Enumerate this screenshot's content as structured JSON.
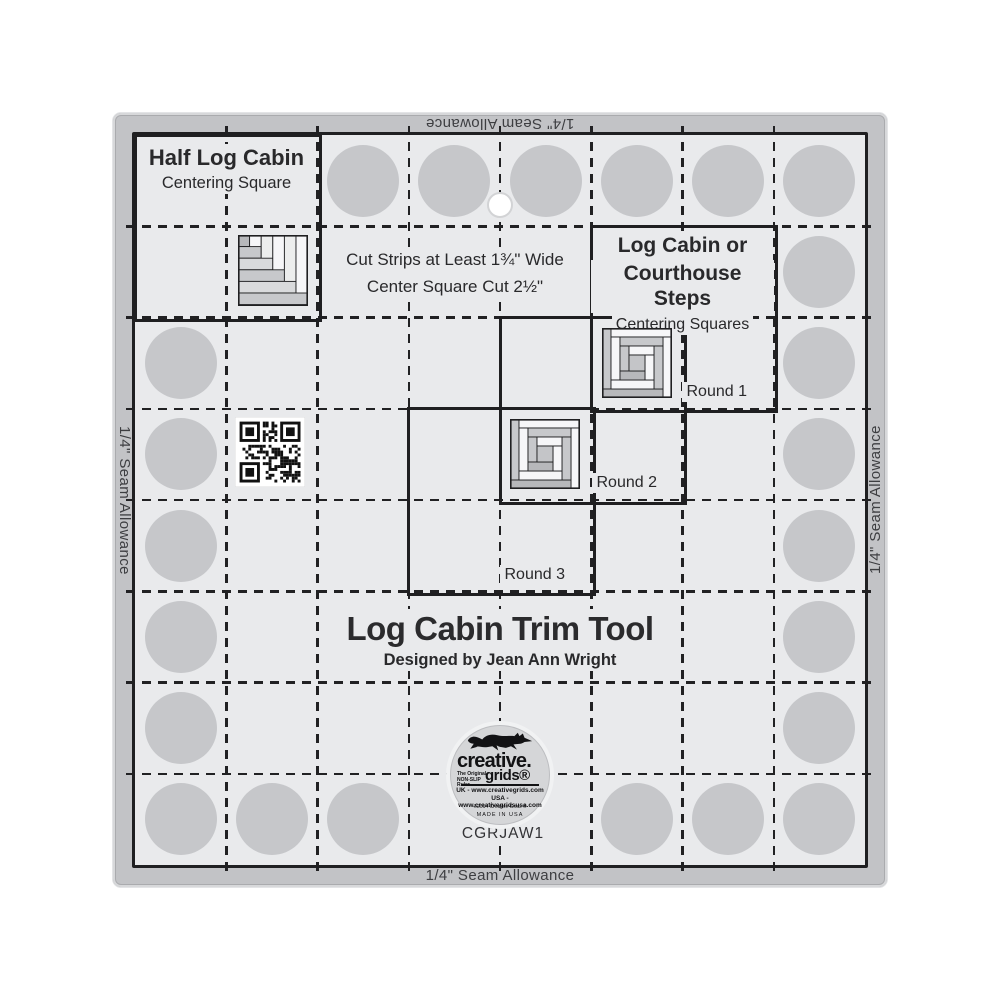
{
  "product": {
    "title": "Log Cabin Trim Tool",
    "designer": "Designed by Jean Ann Wright",
    "sku": "CGRJAW1",
    "seam_allowance_label": "1/4\" Seam Allowance"
  },
  "sections": {
    "half_log_cabin": {
      "title": "Half Log Cabin",
      "subtitle": "Centering Square"
    },
    "log_cabin_courthouse": {
      "line1": "Log Cabin or",
      "line2": "Courthouse Steps",
      "subtitle": "Centering Squares"
    },
    "instructions": {
      "line1": "Cut Strips at Least 1¾\" Wide",
      "line2": "Center Square Cut 2½\""
    },
    "rounds": [
      "Round 1",
      "Round 2",
      "Round 3"
    ]
  },
  "logo": {
    "brand_top": "creative.",
    "brand_bottom": "grids®",
    "tagline": "The Original NON-SLIP Ruler",
    "uk_line": "UK - www.creativegrids.com",
    "usa_line": "USA - www.creativegridsusa.com",
    "copyright_line": "©2014 Creative Grids ®",
    "made_in": "MADE IN USA"
  },
  "colors": {
    "ruler_body": "#e9eaec",
    "seam_band": "#c2c3c6",
    "grip_dot": "#c6c7ca",
    "line": "#212123",
    "logo_fill": "#d5d6d8",
    "accent_white": "#ffffff"
  }
}
